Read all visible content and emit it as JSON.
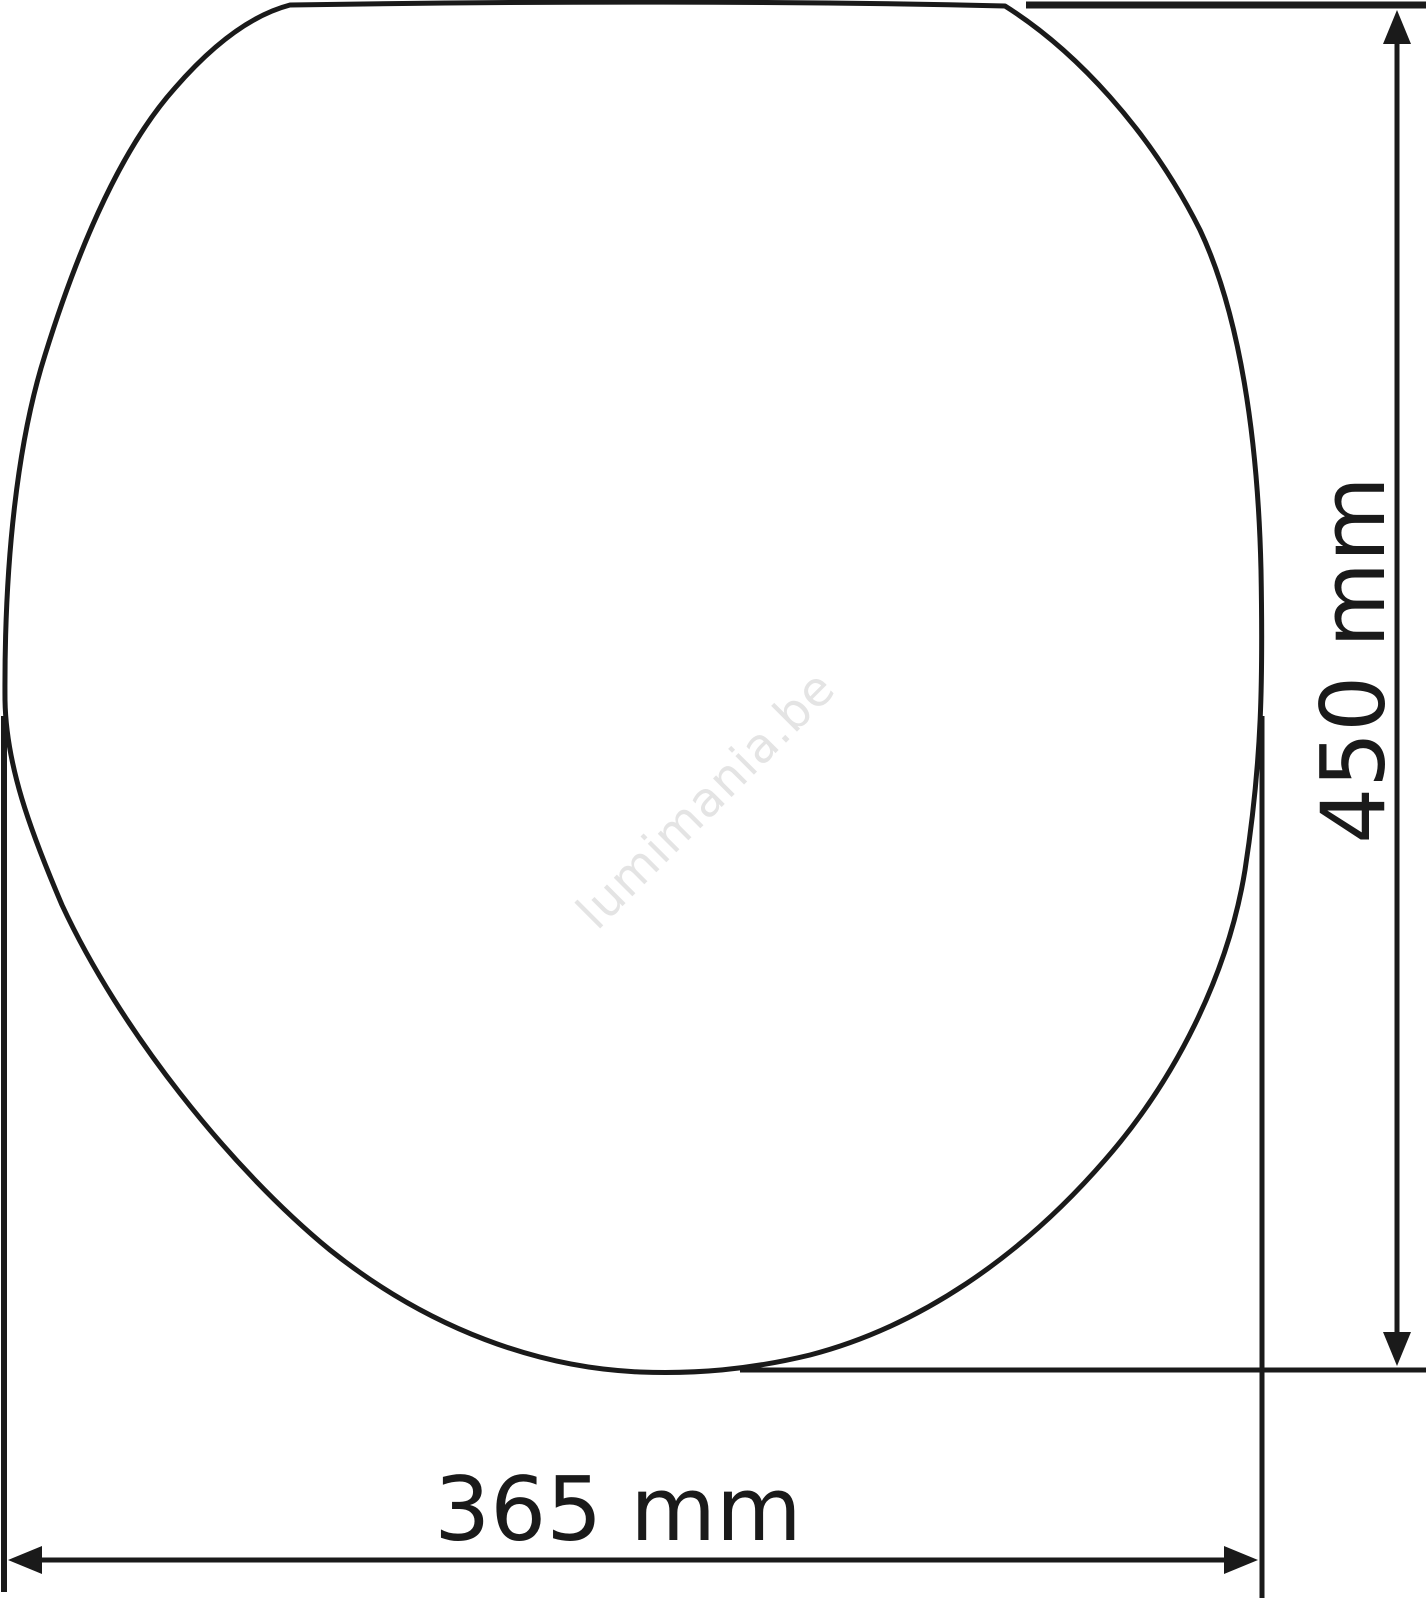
{
  "diagram": {
    "subject": "toilet-seat-top-view",
    "watermark": "lumimania.be",
    "dimensions": {
      "height": {
        "label": "450 mm",
        "value_mm": 450,
        "unit": "mm"
      },
      "width": {
        "label": "365 mm",
        "value_mm": 365,
        "unit": "mm"
      }
    },
    "colors": {
      "line": "#1a1a1a",
      "watermark": "#e4e4e4",
      "background": "#ffffff"
    }
  }
}
